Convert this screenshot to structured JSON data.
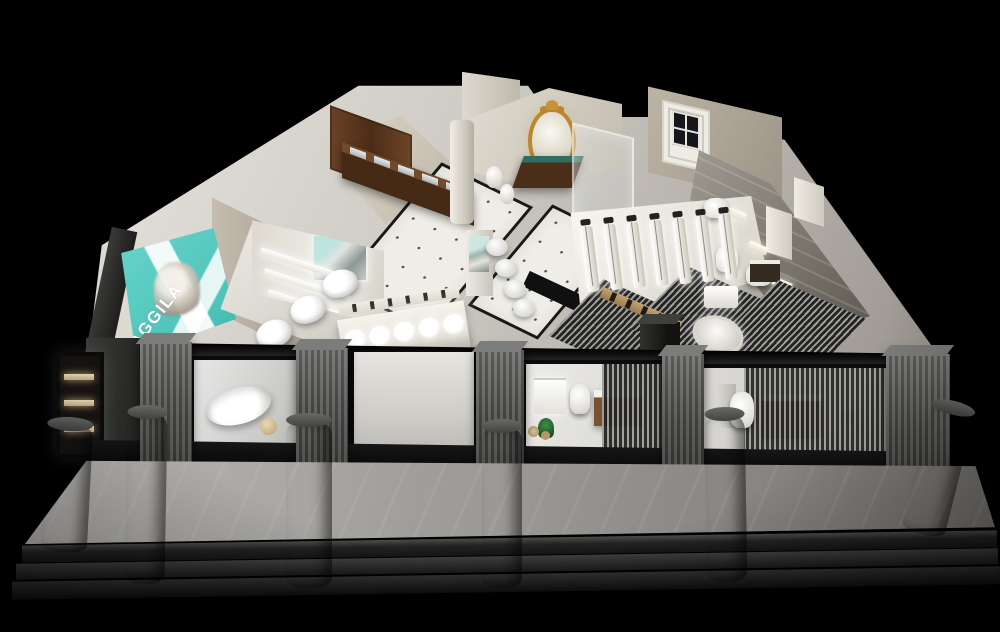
{
  "scene": {
    "description": "Night-time 3D cutaway render of a sanitary-ware showroom interior",
    "background_color": "#000000"
  },
  "brand": {
    "name": "AGGILA",
    "billboard_color": "#54cdc3",
    "billboard_text_color": "#ffffff"
  },
  "palette": {
    "interior_floor": "#d8d5cf",
    "tile_floor": "#efede7",
    "dark_wood": "#4b2e1a",
    "warm_wood": "#7a5230",
    "marble_wall": "#8f8b83",
    "storefront_frame": "#0b0b0b",
    "pillar_gray": "#55555三3",
    "column_gray": "#3a3a38",
    "gold_mirror_frame": "#b8872f",
    "glow_white": "#f7f5ef"
  },
  "counts": {
    "shower_panels": 7,
    "display_basins": 5,
    "toilet_row": 3,
    "front_columns": 6,
    "steps": 3,
    "alcove_shelves": 3,
    "small_window_shelves": 3,
    "bottle_items": 6,
    "shelf_items": 4,
    "wall_vents": 5,
    "metal_sinks": 5,
    "pedestal_basins": 4,
    "wall_niches": 3
  },
  "areas": [
    {
      "id": "brand-billboard",
      "label": "teal brand lightbox on left wall"
    },
    {
      "id": "toilet-display",
      "label": "row of display toilets"
    },
    {
      "id": "faucet-alcove",
      "label": "illuminated faucet shelves"
    },
    {
      "id": "wood-vanity-row",
      "label": "dark wood vanity counter"
    },
    {
      "id": "tile-floor",
      "label": "white dotted tile floor"
    },
    {
      "id": "basin-display-table",
      "label": "lit washbasin display table"
    },
    {
      "id": "gold-mirror-vignette",
      "label": "classical gold mirror vanity set"
    },
    {
      "id": "shower-display-hall",
      "label": "illuminated shower column wall"
    },
    {
      "id": "right-marble-rooms",
      "label": "marble bathroom displays"
    },
    {
      "id": "slat-partitions",
      "label": "gray slatted partition walls"
    },
    {
      "id": "storefront",
      "label": "black framed glass storefront"
    },
    {
      "id": "display-window-bathtub",
      "label": "bathtub window vignette"
    },
    {
      "id": "display-window-vanity",
      "label": "vanity and toilet window vignette"
    },
    {
      "id": "display-window-wood-vanity",
      "label": "walnut vanity window vignette"
    },
    {
      "id": "walkway",
      "label": "front concrete walkway"
    },
    {
      "id": "entry-steps",
      "label": "dark entry steps"
    },
    {
      "id": "front-columns",
      "label": "round concrete columns"
    }
  ]
}
